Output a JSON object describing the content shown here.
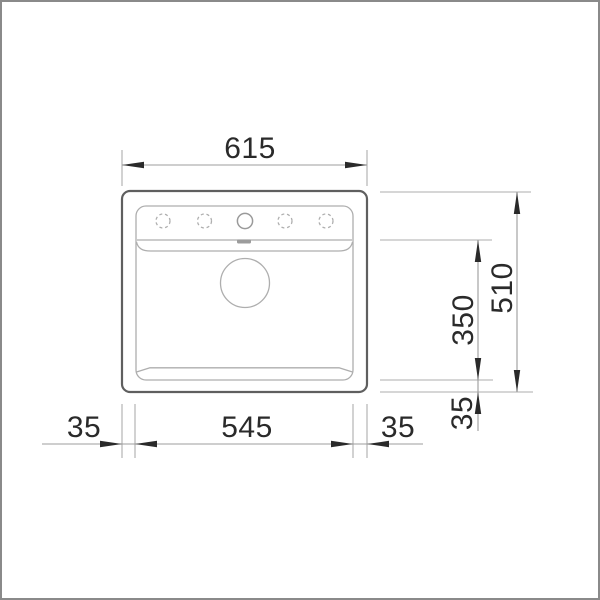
{
  "drawing": {
    "subject": "sink-top-view-dimension-drawing",
    "tap_hole_count": 5
  },
  "dims": {
    "width_total": "615",
    "width_inner": "545",
    "width_left": "35",
    "width_right": "35",
    "depth_total": "510",
    "depth_inner": "350",
    "depth_bottom": "35"
  },
  "colors": {
    "outline": "#5f5f5f",
    "detail": "#aeaeae",
    "dim": "#9c9c9c",
    "ink": "#2a2a2a",
    "frame": "#8a8a8a"
  }
}
